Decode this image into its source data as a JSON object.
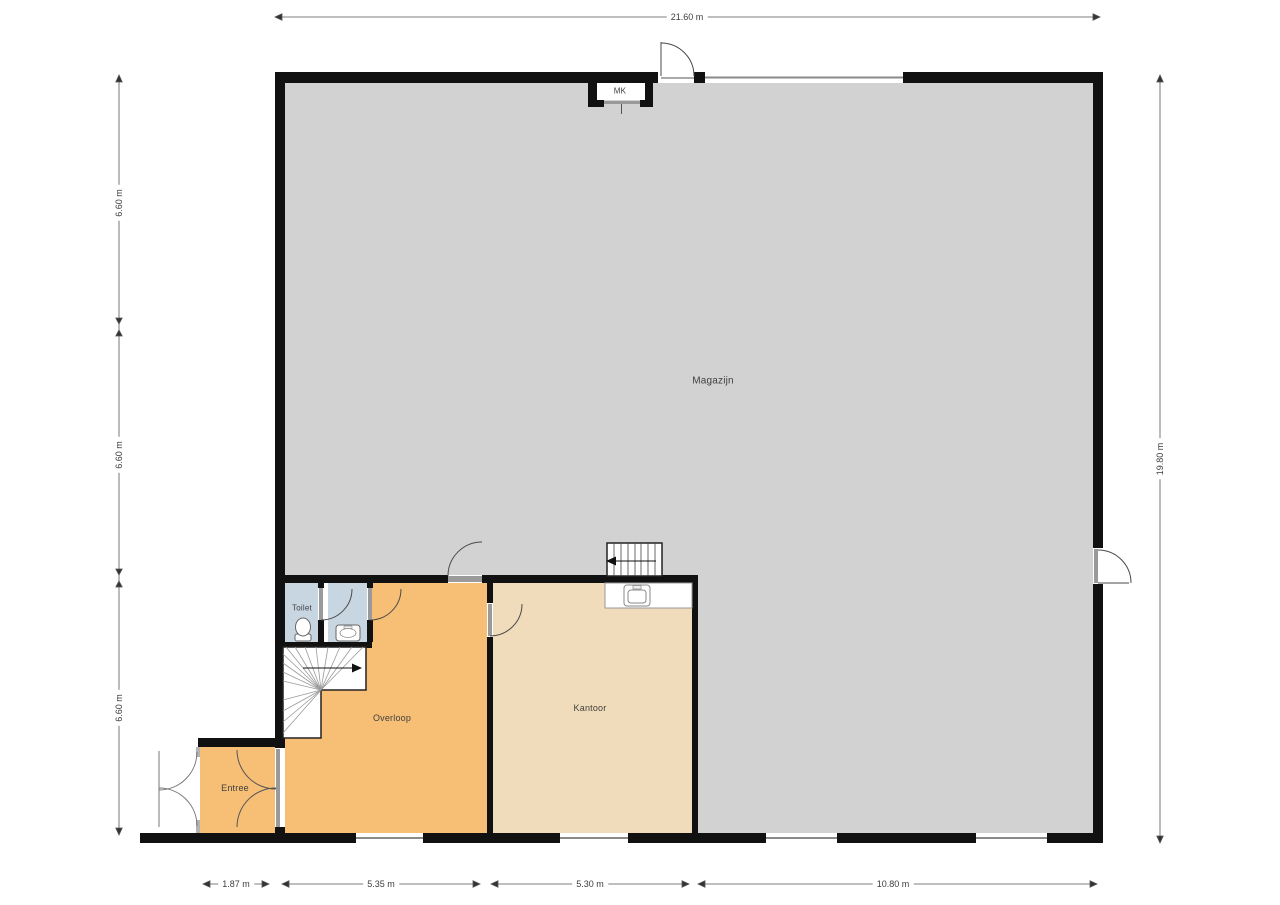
{
  "rooms": {
    "magazijn": "Magazijn",
    "kantoor": "Kantoor",
    "overloop": "Overloop",
    "entree": "Entree",
    "toilet": "Toilet",
    "mk": "MK"
  },
  "dimensions": {
    "top": "21.60 m",
    "right": "19.80 m",
    "left": [
      "6.60 m",
      "6.60 m",
      "6.60 m"
    ],
    "bottom": [
      "1.87 m",
      "5.35 m",
      "5.30 m",
      "10.80 m"
    ]
  },
  "colors": {
    "wall": "#111111",
    "magazijn_floor": "#d2d2d2",
    "overloop_floor": "#f7bf75",
    "entree_floor": "#f7bf75",
    "kantoor_floor": "#f0dcba",
    "toilet_floor": "#c8d6e2",
    "dimension_text": "#3c3c3c"
  }
}
